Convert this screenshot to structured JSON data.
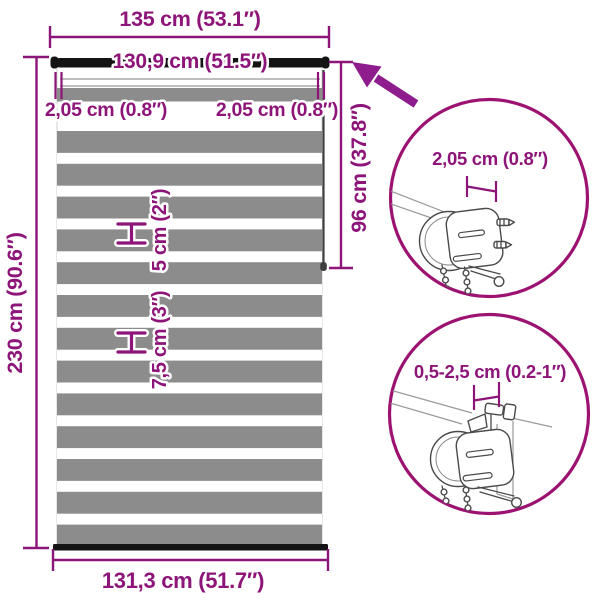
{
  "diagram_title": "Zebra roller blind dimension diagram",
  "colors": {
    "accent": "#8D1478",
    "arrow": "#8E1C8D",
    "circle_stroke": "#9C1271",
    "stripe_gray": "#8C8C8C",
    "bar_black": "#141414",
    "line_art": "#4a4a4a"
  },
  "measurements": {
    "total_width": "135 cm (53.1″)",
    "tube_width": "130,9 cm (51.5″)",
    "side_offset_left": "2,05 cm (0.8″)",
    "side_offset_right": "2,05 cm (0.8″)",
    "total_height": "230 cm (90.6″)",
    "roll_height": "96 cm (37.8″)",
    "stripe_small": "5 cm (2″)",
    "stripe_large": "7,5 cm (3″)",
    "fabric_width": "131,3 cm (51.7″)"
  },
  "details": {
    "bracket_depth": {
      "label": "2,05 cm (0.8″)"
    },
    "clamp_range": {
      "label": "0,5-2,5 cm (0.2-1″)"
    }
  }
}
